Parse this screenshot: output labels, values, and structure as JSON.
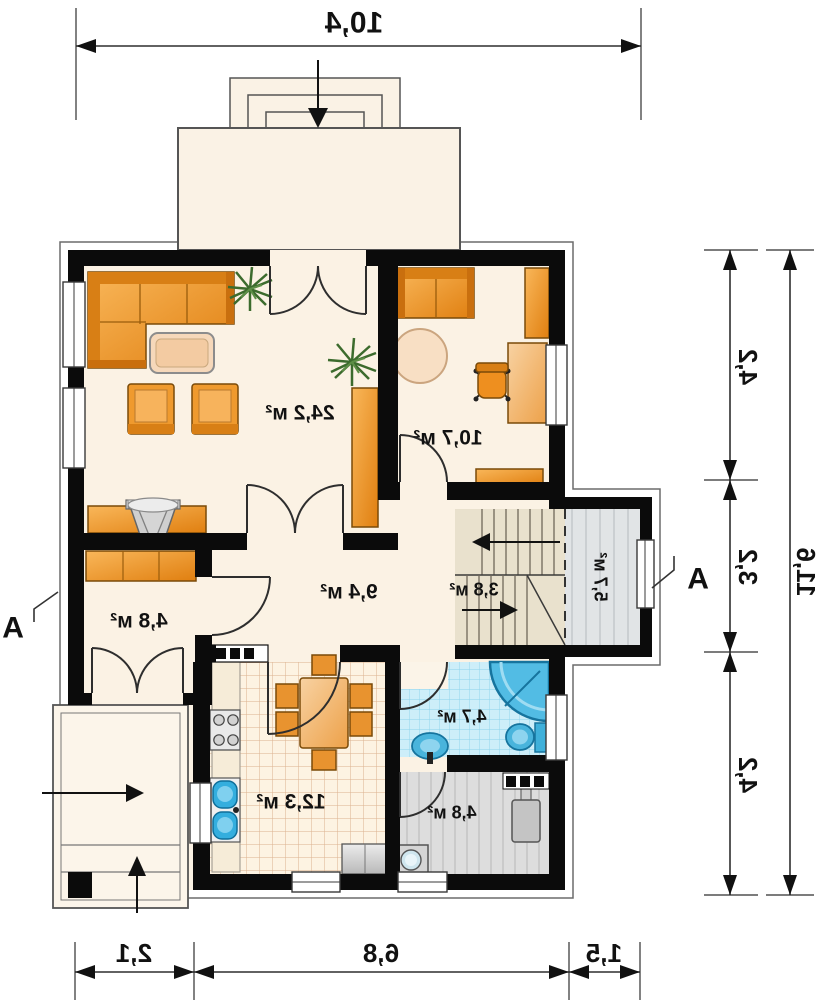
{
  "rooms": {
    "living": {
      "label": "24,2 м²"
    },
    "bedroom": {
      "label": "10,7 м²"
    },
    "hall": {
      "label": "9,4 м²"
    },
    "entry": {
      "label": "4,8 м²"
    },
    "stairs": {
      "label": "3,8 м²"
    },
    "storage": {
      "label": "5,7 м²"
    },
    "kitchen": {
      "label": "12,3 м²"
    },
    "bathroom": {
      "label": "4,7 м²"
    },
    "utility": {
      "label": "4,8 м²"
    }
  },
  "dimensions": {
    "top_total": "10,4",
    "bottom_left": "2,1",
    "bottom_middle": "6,8",
    "bottom_right": "1,5",
    "right_top": "4,2",
    "right_middle": "3,2",
    "right_bottom": "4,2",
    "right_total": "11,6"
  },
  "markers": {
    "section_left": "A",
    "section_right": "A"
  },
  "colors": {
    "wall": "#0b0b0b",
    "floor_cream": "#fbf2e4",
    "furniture_orange": "#ef9a2e",
    "fixture_blue": "#45b6e0",
    "bath_tile": "#cdeef9",
    "kitchen_tile": "#fdf3e2",
    "stairs_tan": "#e9e1cd",
    "utility_gray": "#dddddd"
  }
}
